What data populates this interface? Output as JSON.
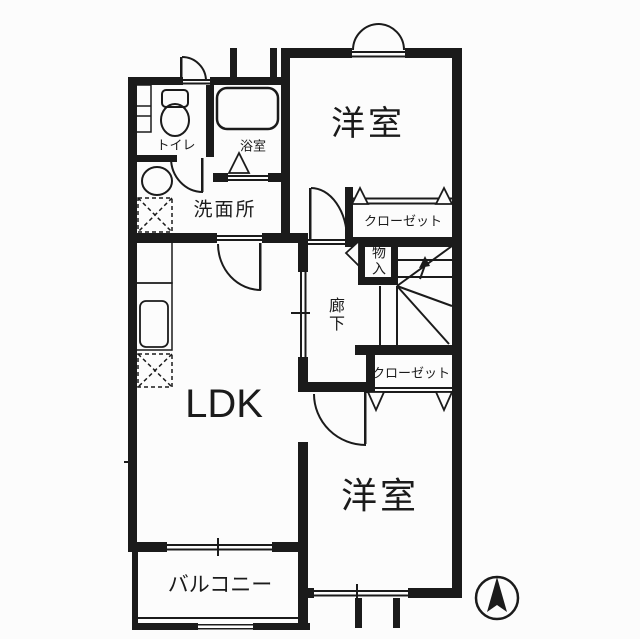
{
  "plan": {
    "type": "floor-plan",
    "rooms": {
      "toilet": "トイレ",
      "bath": "浴室",
      "washroom": "洗面所",
      "bedroom_top": "洋室",
      "closet_top": "クローゼット",
      "storage": "物入",
      "hallway": "廊下",
      "ldk": "LDK",
      "closet_bottom": "クローゼット",
      "bedroom_bottom": "洋室",
      "balcony": "バルコニー"
    },
    "compass": "north-arrow",
    "colors": {
      "ink": "#1b1b1b",
      "paper": "#fcfcfc"
    }
  }
}
